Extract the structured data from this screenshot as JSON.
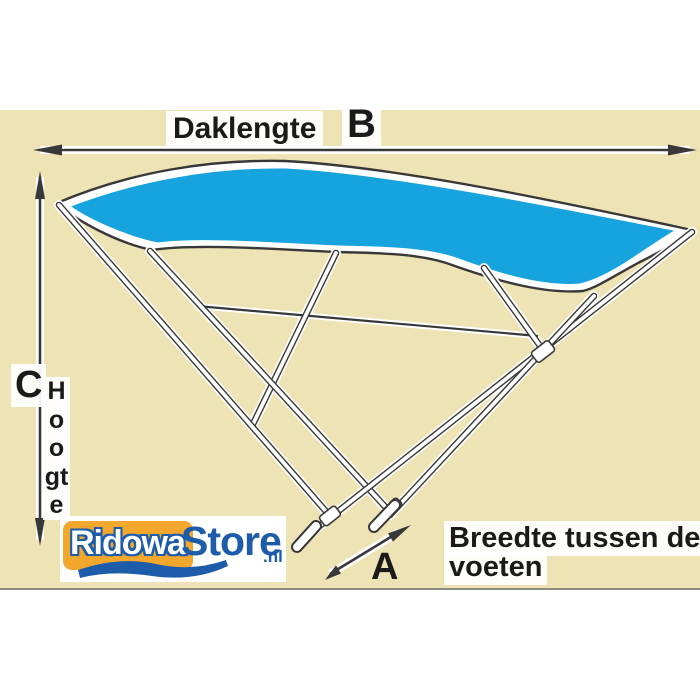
{
  "diagram": {
    "measurements": {
      "roof_length_label": "Daklengte",
      "b": "B",
      "c": "C",
      "a": "A",
      "height_label": "Hoogte",
      "feet_width_line1": "Breedte tussen de",
      "feet_width_line2": "voeten"
    },
    "logo": {
      "name_part1": "Ridowa",
      "name_part2": "Store",
      "tld": ".nl"
    },
    "colors": {
      "beige": "#EEE3B4",
      "line": "#383838",
      "canopy": "#16A3DE",
      "logo-orange": "#F4A72D",
      "logo-blue": "#1D5CA9",
      "text": "#1a1a1a"
    }
  }
}
